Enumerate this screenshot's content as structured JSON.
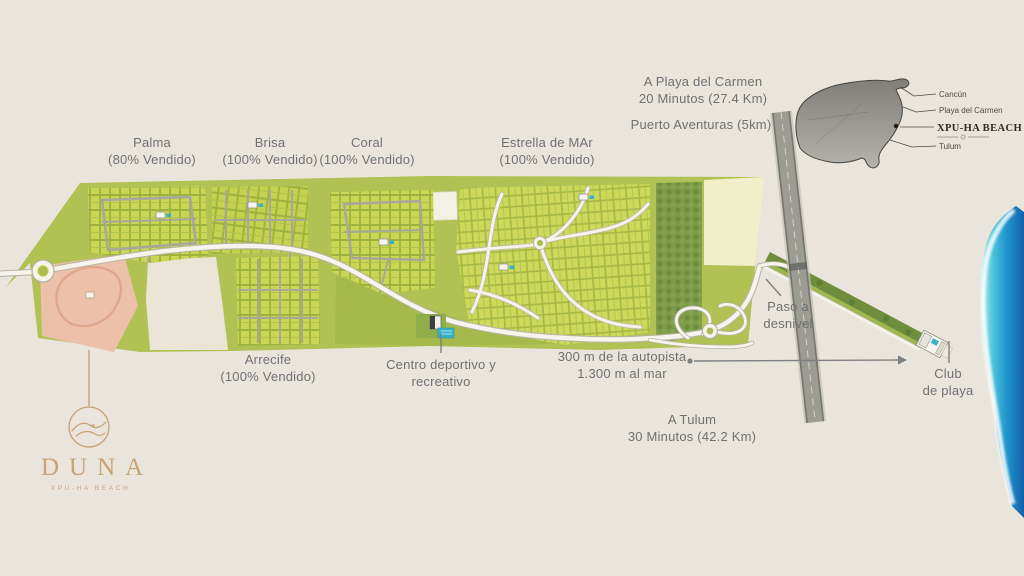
{
  "map_labels": {
    "playa_del_carmen": {
      "line1": "A Playa del Carmen",
      "line2": "20 Minutos (27.4 Km)"
    },
    "puerto_aventuras": {
      "line1": "Puerto Aventuras (5km)"
    },
    "palma": {
      "name": "Palma",
      "status": "(80% Vendido)"
    },
    "brisa": {
      "name": "Brisa",
      "status": "(100% Vendido)"
    },
    "coral": {
      "name": "Coral",
      "status": "(100% Vendido)"
    },
    "estrella_de_mar": {
      "name": "Estrella de MAr",
      "status": "(100% Vendido)"
    },
    "arrecife": {
      "name": "Arrecife",
      "status": "(100% Vendido)"
    },
    "centro_deportivo": {
      "line1": "Centro deportivo y",
      "line2": "recreativo"
    },
    "autopista": {
      "line1": "300 m de la autopista",
      "line2": "1.300 m al mar"
    },
    "paso_desnivel": {
      "line1": "Paso a",
      "line2": "desnivel"
    },
    "tulum": {
      "line1": "A Tulum",
      "line2": "30 Minutos (42.2 Km)"
    },
    "club_de_playa": {
      "line1": "Club",
      "line2": "de playa"
    }
  },
  "inset_map": {
    "cancun": "Cancún",
    "playa_del_carmen": "Playa del Carmen",
    "xpu_ha_beach": "XPU-HA BEACH",
    "tulum": "Tulum"
  },
  "logo": {
    "name": "DUNA",
    "subtitle": "XPU-HA BEACH"
  },
  "colors": {
    "sand_background": "#ece7de",
    "map_green": "#b3c451",
    "lot_green": "#c9d654",
    "forest_green": "#7d9c49",
    "cleared_cream": "#f1efca",
    "parcel_pink": "#edc1a9",
    "highway_gray": "#9c9b94",
    "road_white": "#f6f4ec",
    "ocean_deep": "#1261ab",
    "ocean_turquoise": "#4cc4da",
    "pool_teal": "#35b3c9",
    "label_gray": "#6e7174",
    "logo_gold": "#c8a273"
  }
}
